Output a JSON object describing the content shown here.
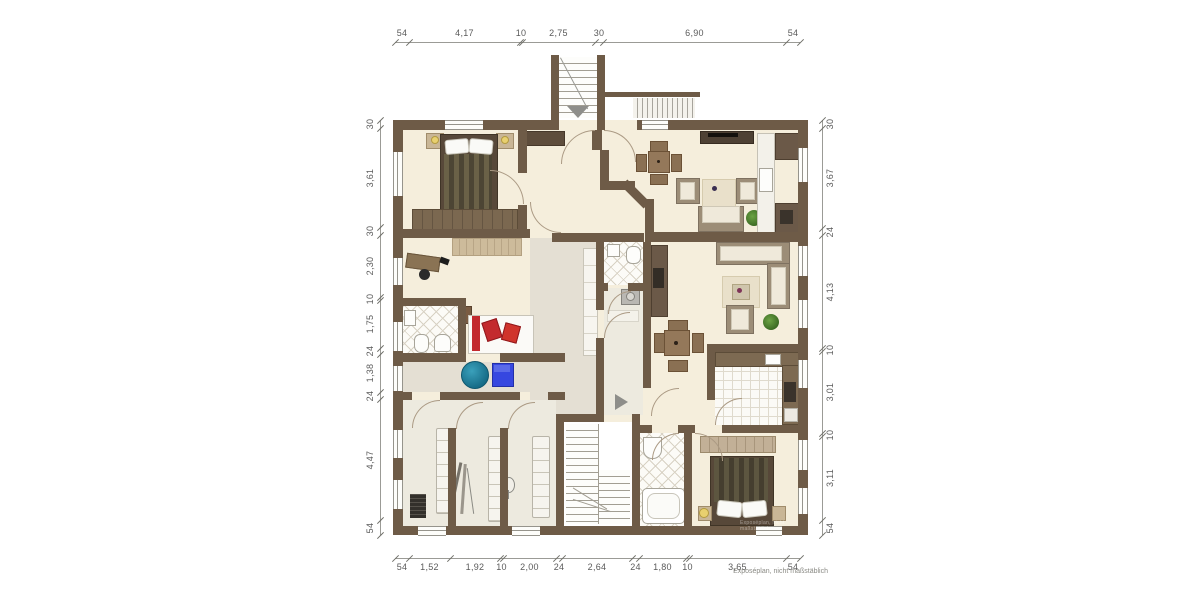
{
  "meta": {
    "footnote": "Exposéplan, nicht maßstäblich",
    "wall_watermark": "Exposéplan, nicht maßstäblich"
  },
  "dimensions": {
    "top": {
      "labels": [
        "54",
        "4,17",
        "10",
        "2,75",
        "30",
        "6,90",
        "54"
      ],
      "bounds": [
        395,
        409,
        520,
        522,
        595,
        603,
        786,
        800
      ]
    },
    "bottom": {
      "labels": [
        "54",
        "1,52",
        "1,92",
        "10",
        "2,00",
        "24",
        "2,64",
        "24",
        "1,80",
        "10",
        "3,65",
        "54"
      ],
      "bounds": [
        395,
        409,
        450,
        500,
        503,
        556,
        562,
        632,
        639,
        686,
        689,
        786,
        800
      ]
    },
    "left": {
      "labels": [
        "30",
        "3,61",
        "30",
        "2,30",
        "10",
        "1,75",
        "24",
        "1,38",
        "24",
        "4,47",
        "54"
      ],
      "bounds": [
        120,
        128,
        227,
        235,
        297,
        300,
        348,
        354,
        392,
        399,
        520,
        535
      ]
    },
    "right": {
      "labels": [
        "30",
        "3,67",
        "24",
        "4,13",
        "10",
        "3,01",
        "10",
        "3,11",
        "54"
      ],
      "bounds": [
        120,
        128,
        228,
        235,
        348,
        351,
        433,
        436,
        520,
        535
      ]
    }
  },
  "colors": {
    "wall": "#6e5b47",
    "room_floor": "#f5eedc",
    "hallway_floor": "#e4dfd3",
    "tile_floor": "#fcfbf7",
    "accent_red": "#c32a2e",
    "accent_blue": "#3647e0",
    "accent_teal": "#1f7e98",
    "plant_green": "#3c6b24",
    "arrow_gray": "#8e8e8a"
  }
}
